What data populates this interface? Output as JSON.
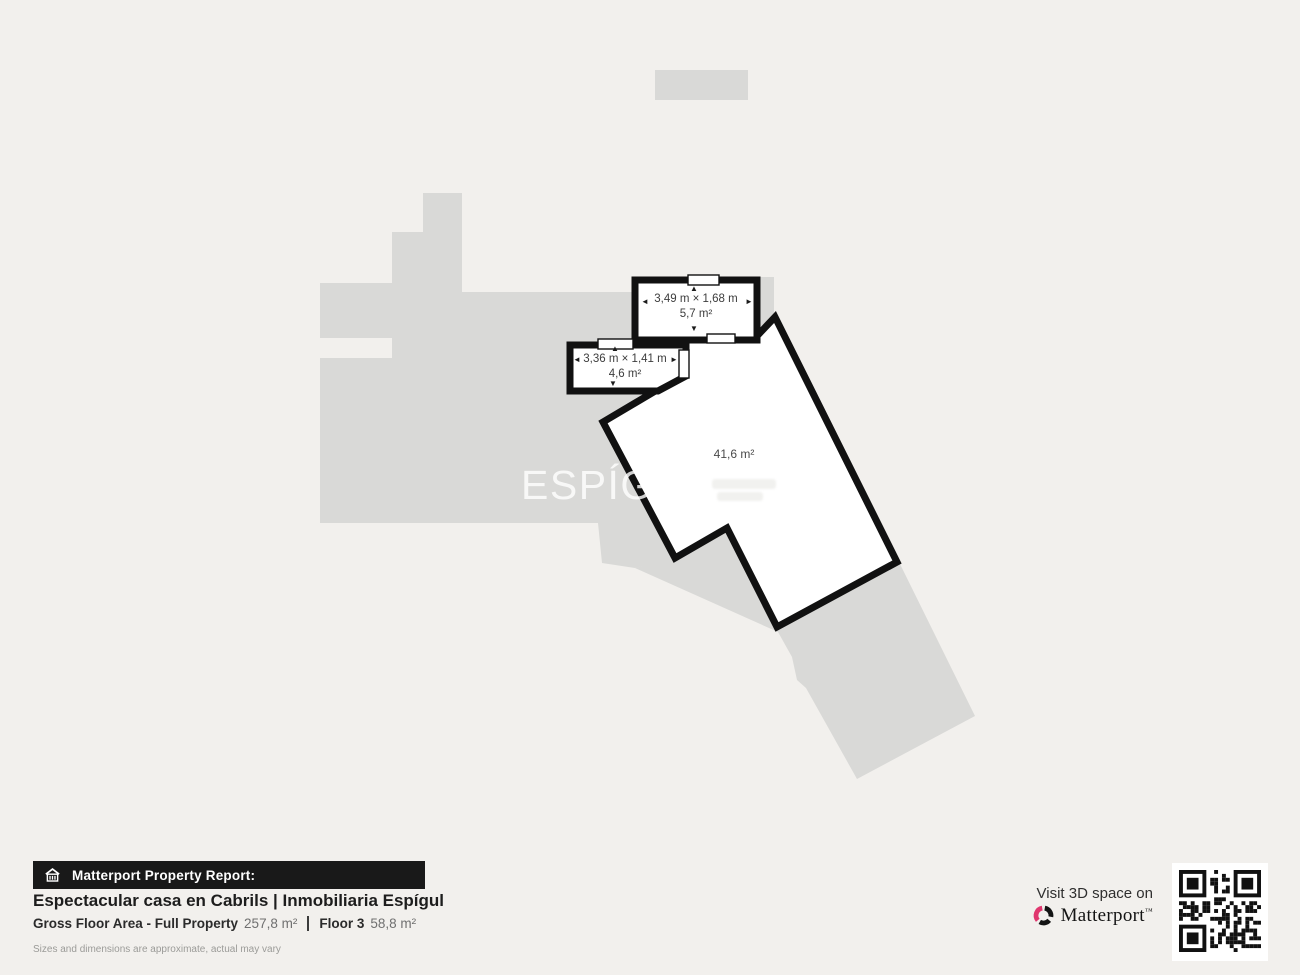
{
  "plan": {
    "watermark": "ESPÍGUL",
    "watermark_reg": "®",
    "rooms": {
      "r57": {
        "dims": "3,49 m × 1,68 m",
        "area": "5,7 m²"
      },
      "r46": {
        "dims": "3,36 m × 1,41 m",
        "area": "4,6 m²"
      },
      "main": {
        "area": "41,6 m²"
      }
    },
    "icons": {
      "arrow_up": "▲",
      "arrow_down": "▼",
      "arrow_left": "◄",
      "arrow_right": "►"
    }
  },
  "footer": {
    "report_label": "Matterport Property Report:",
    "title": "Espectacular casa en Cabrils | Inmobiliaria Espígul",
    "gfa_label": "Gross Floor Area - Full Property",
    "gfa_value": "257,8 m²",
    "floor_label": "Floor 3",
    "floor_value": "58,8 m²",
    "disclaimer": "Sizes and dimensions are approximate, actual may vary"
  },
  "cta": {
    "visit_label": "Visit 3D space on",
    "brand": "Matterport",
    "brand_tm": "™"
  },
  "colors": {
    "background": "#f2f0ed",
    "silhouette": "#d9d9d7",
    "wall": "#111111",
    "room_fill": "#ffffff",
    "brand_pink": "#e0366e",
    "bar_bg": "#191919"
  }
}
